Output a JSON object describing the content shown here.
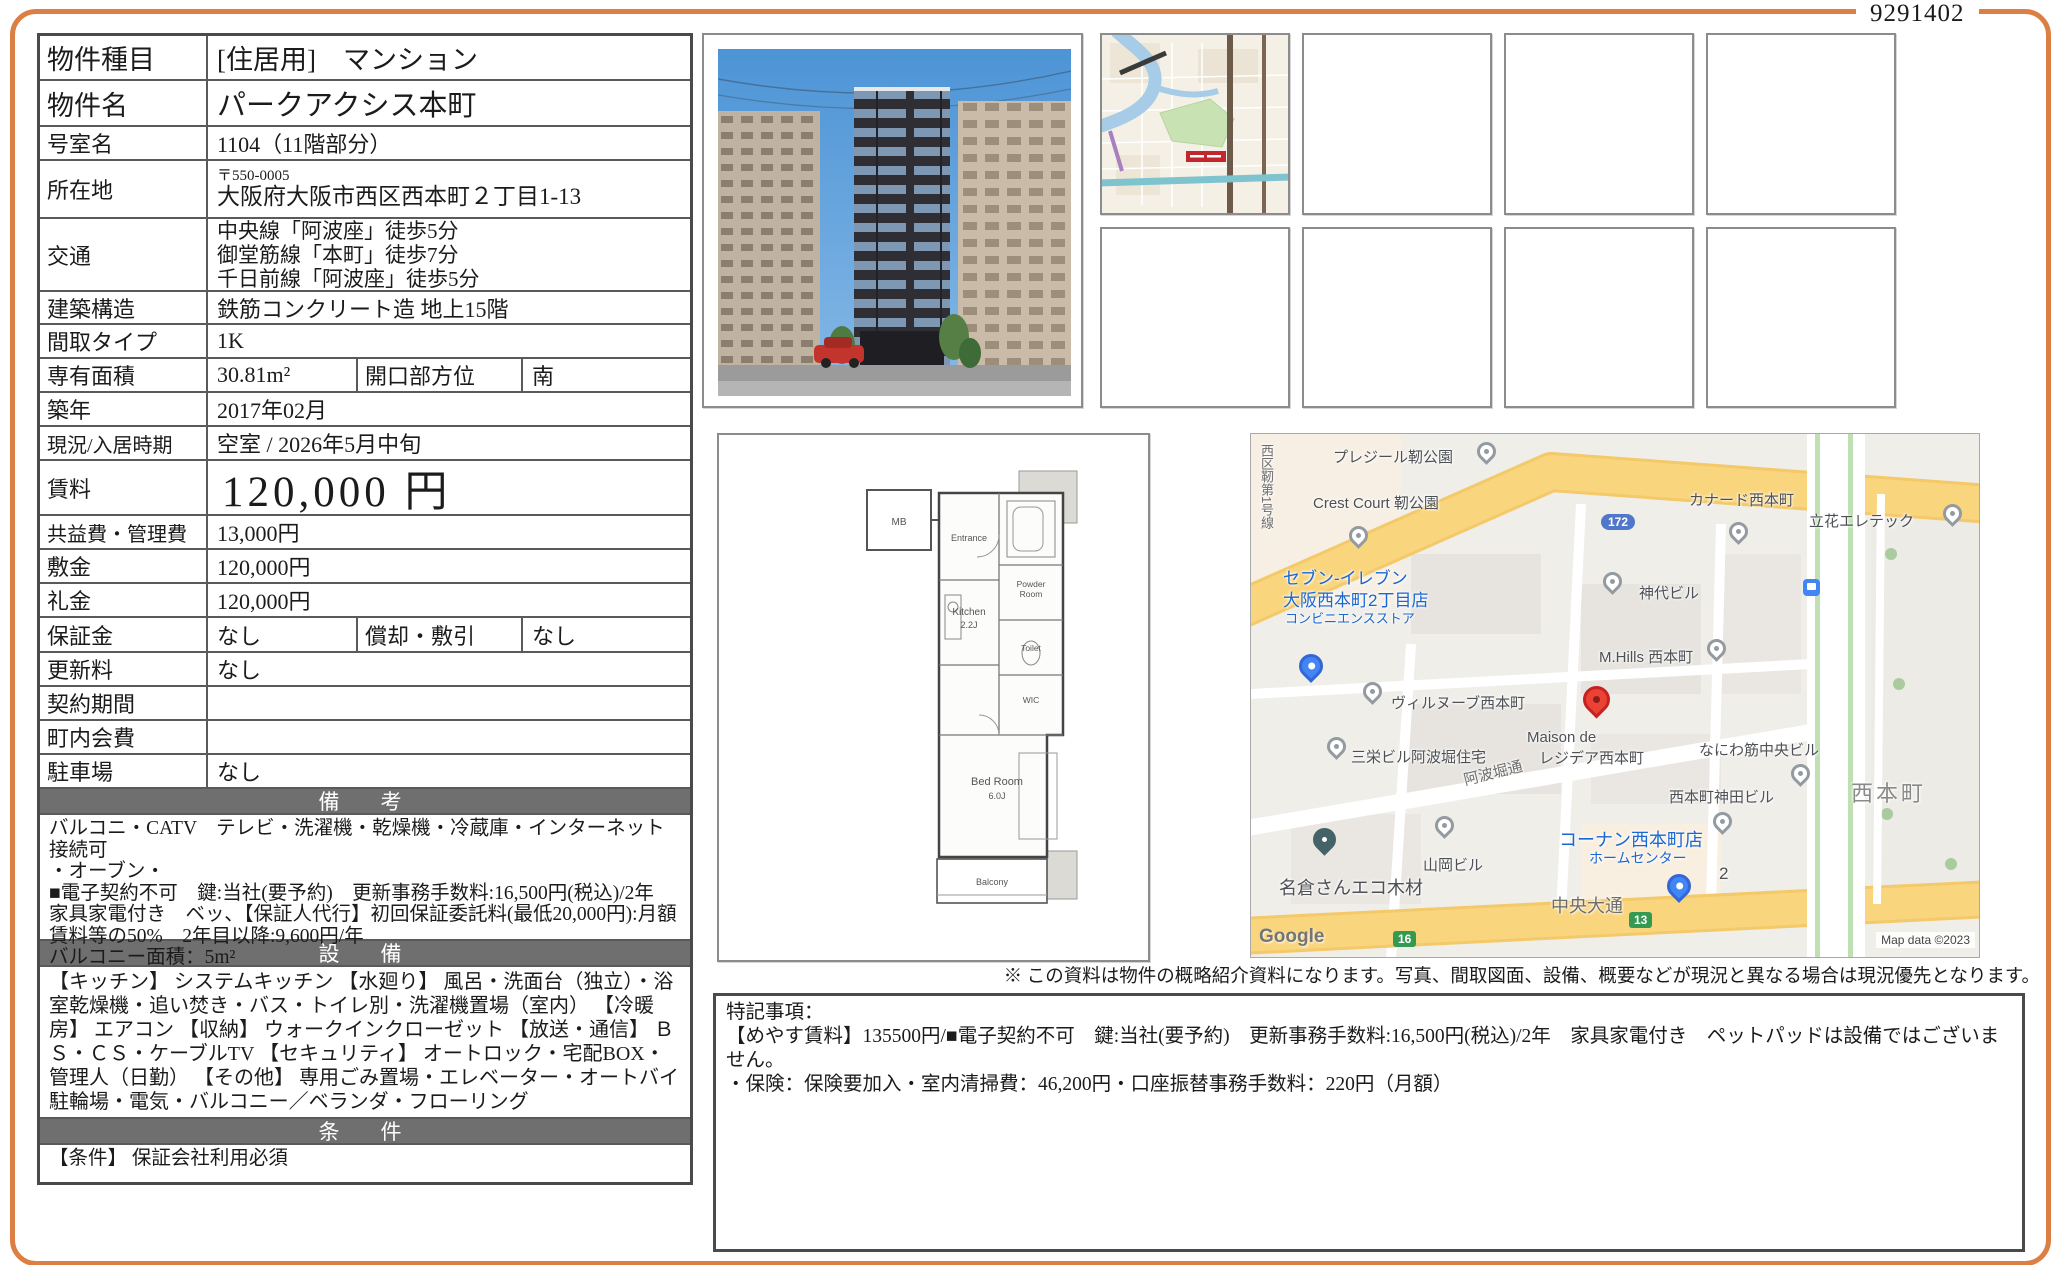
{
  "doc_id": "9291402",
  "colors": {
    "accent_orange": "#DC7F45",
    "section_bar": "#6F6F6F",
    "map_road_yellow": "#F9D57E",
    "pin_red": "#EA4335",
    "map_blue_text": "#1A67D2"
  },
  "table": {
    "rows": [
      {
        "label": "物件種目",
        "value": "[住居用]　マンション"
      },
      {
        "label": "物件名",
        "value": "パークアクシス本町"
      },
      {
        "label": "号室名",
        "value": "1104（11階部分）"
      },
      {
        "label": "所在地",
        "postal": "〒550-0005",
        "value": "大阪府大阪市西区西本町２丁目1-13"
      },
      {
        "label": "交通",
        "lines": [
          "中央線「阿波座」徒歩5分",
          "御堂筋線「本町」徒歩7分",
          "千日前線「阿波座」徒歩5分"
        ]
      },
      {
        "label": "建築構造",
        "value": "鉄筋コンクリート造 地上15階"
      },
      {
        "label": "間取タイプ",
        "value": "1K"
      },
      {
        "label": "専有面積",
        "value": "30.81m²",
        "label2": "開口部方位",
        "value2": "南"
      },
      {
        "label": "築年",
        "value": "2017年02月"
      },
      {
        "label": "現況/入居時期",
        "value": "空室 /  2026年5月中旬"
      },
      {
        "label": "賃料",
        "value": "120,000 円"
      },
      {
        "label": "共益費・管理費",
        "value": "13,000円"
      },
      {
        "label": "敷金",
        "value": "120,000円"
      },
      {
        "label": "礼金",
        "value": "120,000円"
      },
      {
        "label": "保証金",
        "value": "なし",
        "label2": "償却・敷引",
        "value2": "なし"
      },
      {
        "label": "更新料",
        "value": "なし"
      },
      {
        "label": "契約期間",
        "value": ""
      },
      {
        "label": "町内会費",
        "value": ""
      },
      {
        "label": "駐車場",
        "value": "なし"
      }
    ]
  },
  "sections": {
    "biko": {
      "title": "備　考",
      "lines": [
        "バルコニ・CATV　テレビ・洗濯機・乾燥機・冷蔵庫・インターネット接続可",
        "・オーブン・",
        "■電子契約不可　鍵:当社(要予約)　更新事務手数料:16,500円(税込)/2年　家具家電付き　ベッ、【保証人代行】初回保証委託料(最低20,000円):月額賃料等の50%　2年目以降:9,600円/年",
        "バルコニー面積：5m²"
      ]
    },
    "setsubi": {
      "title": "設　備",
      "text": "【キッチン】 システムキッチン 【水廻り】 風呂・洗面台（独立）・浴室乾燥機・追い焚き・バス・トイレ別・洗濯機置場（室内） 【冷暖房】 エアコン 【収納】 ウォークインクローゼット 【放送・通信】 ＢＳ・ＣＳ・ケーブルTV 【セキュリティ】 オートロック・宅配BOX・管理人（日勤） 【その他】 専用ごみ置場・エレベーター・オートバイ駐輪場・電気・バルコニー／ベランダ・フローリング"
    },
    "joken": {
      "title": "条　件",
      "text": "【条件】 保証会社利用必須"
    }
  },
  "disclaimer": "※ この資料は物件の概略紹介資料になります。写真、間取図面、設備、概要などが現況と異なる場合は現況優先となります。",
  "tokki": {
    "title": "特記事項：",
    "line1": "【めやす賃料】135500円/■電子契約不可　鍵:当社(要予約)　更新事務手数料:16,500円(税込)/2年　家具家電付き　ペットパッドは設備ではございません。",
    "line2": "・保険：保険要加入・室内清掃費：46,200円・口座振替事務手数料：220円（月額）"
  },
  "gmap": {
    "labels": {
      "plaisir": "プレジール靭公園",
      "crest": "Crest Court 靭公園",
      "nishiku_road": "西区靭第1号線",
      "canard": "カナード西本町",
      "tachibana": "立花エレテック",
      "seven1": "セブン-イレブン",
      "seven2": "大阪西本町2丁目店",
      "seven3": "コンビニエンスストア",
      "jindai": "神代ビル",
      "mhills": "M.Hills 西本町",
      "villeneuve": "ヴィルヌーブ西本町",
      "sanei": "三栄ビル阿波堀住宅",
      "maison1": "Maison de",
      "maison2": "レジデア西本町",
      "naniwa_bldg": "なにわ筋中央ビル",
      "awabori": "阿波堀通",
      "kanda": "西本町神田ビル",
      "nishihonmachi": "西本町",
      "kohnan1": "コーナン西本町店",
      "kohnan2": "ホームセンター",
      "two": "2",
      "yamaoka": "山岡ビル",
      "nagura": "名倉さんエコ木材",
      "chuo": "中央大通",
      "google": "Google",
      "attribution": "Map data ©2023"
    },
    "shields": {
      "blue172": "172",
      "green16": "16",
      "green13": "13"
    }
  },
  "floorplan": {
    "mb": "MB",
    "entrance": "Entrance",
    "kitchen": "Kitchen",
    "kitchen_size": "2.2J",
    "powder1": "Powder",
    "powder2": "Room",
    "toilet": "Toilet",
    "wic": "WIC",
    "bedroom": "Bed Room",
    "bedroom_size": "6.0J",
    "balcony": "Balcony"
  }
}
